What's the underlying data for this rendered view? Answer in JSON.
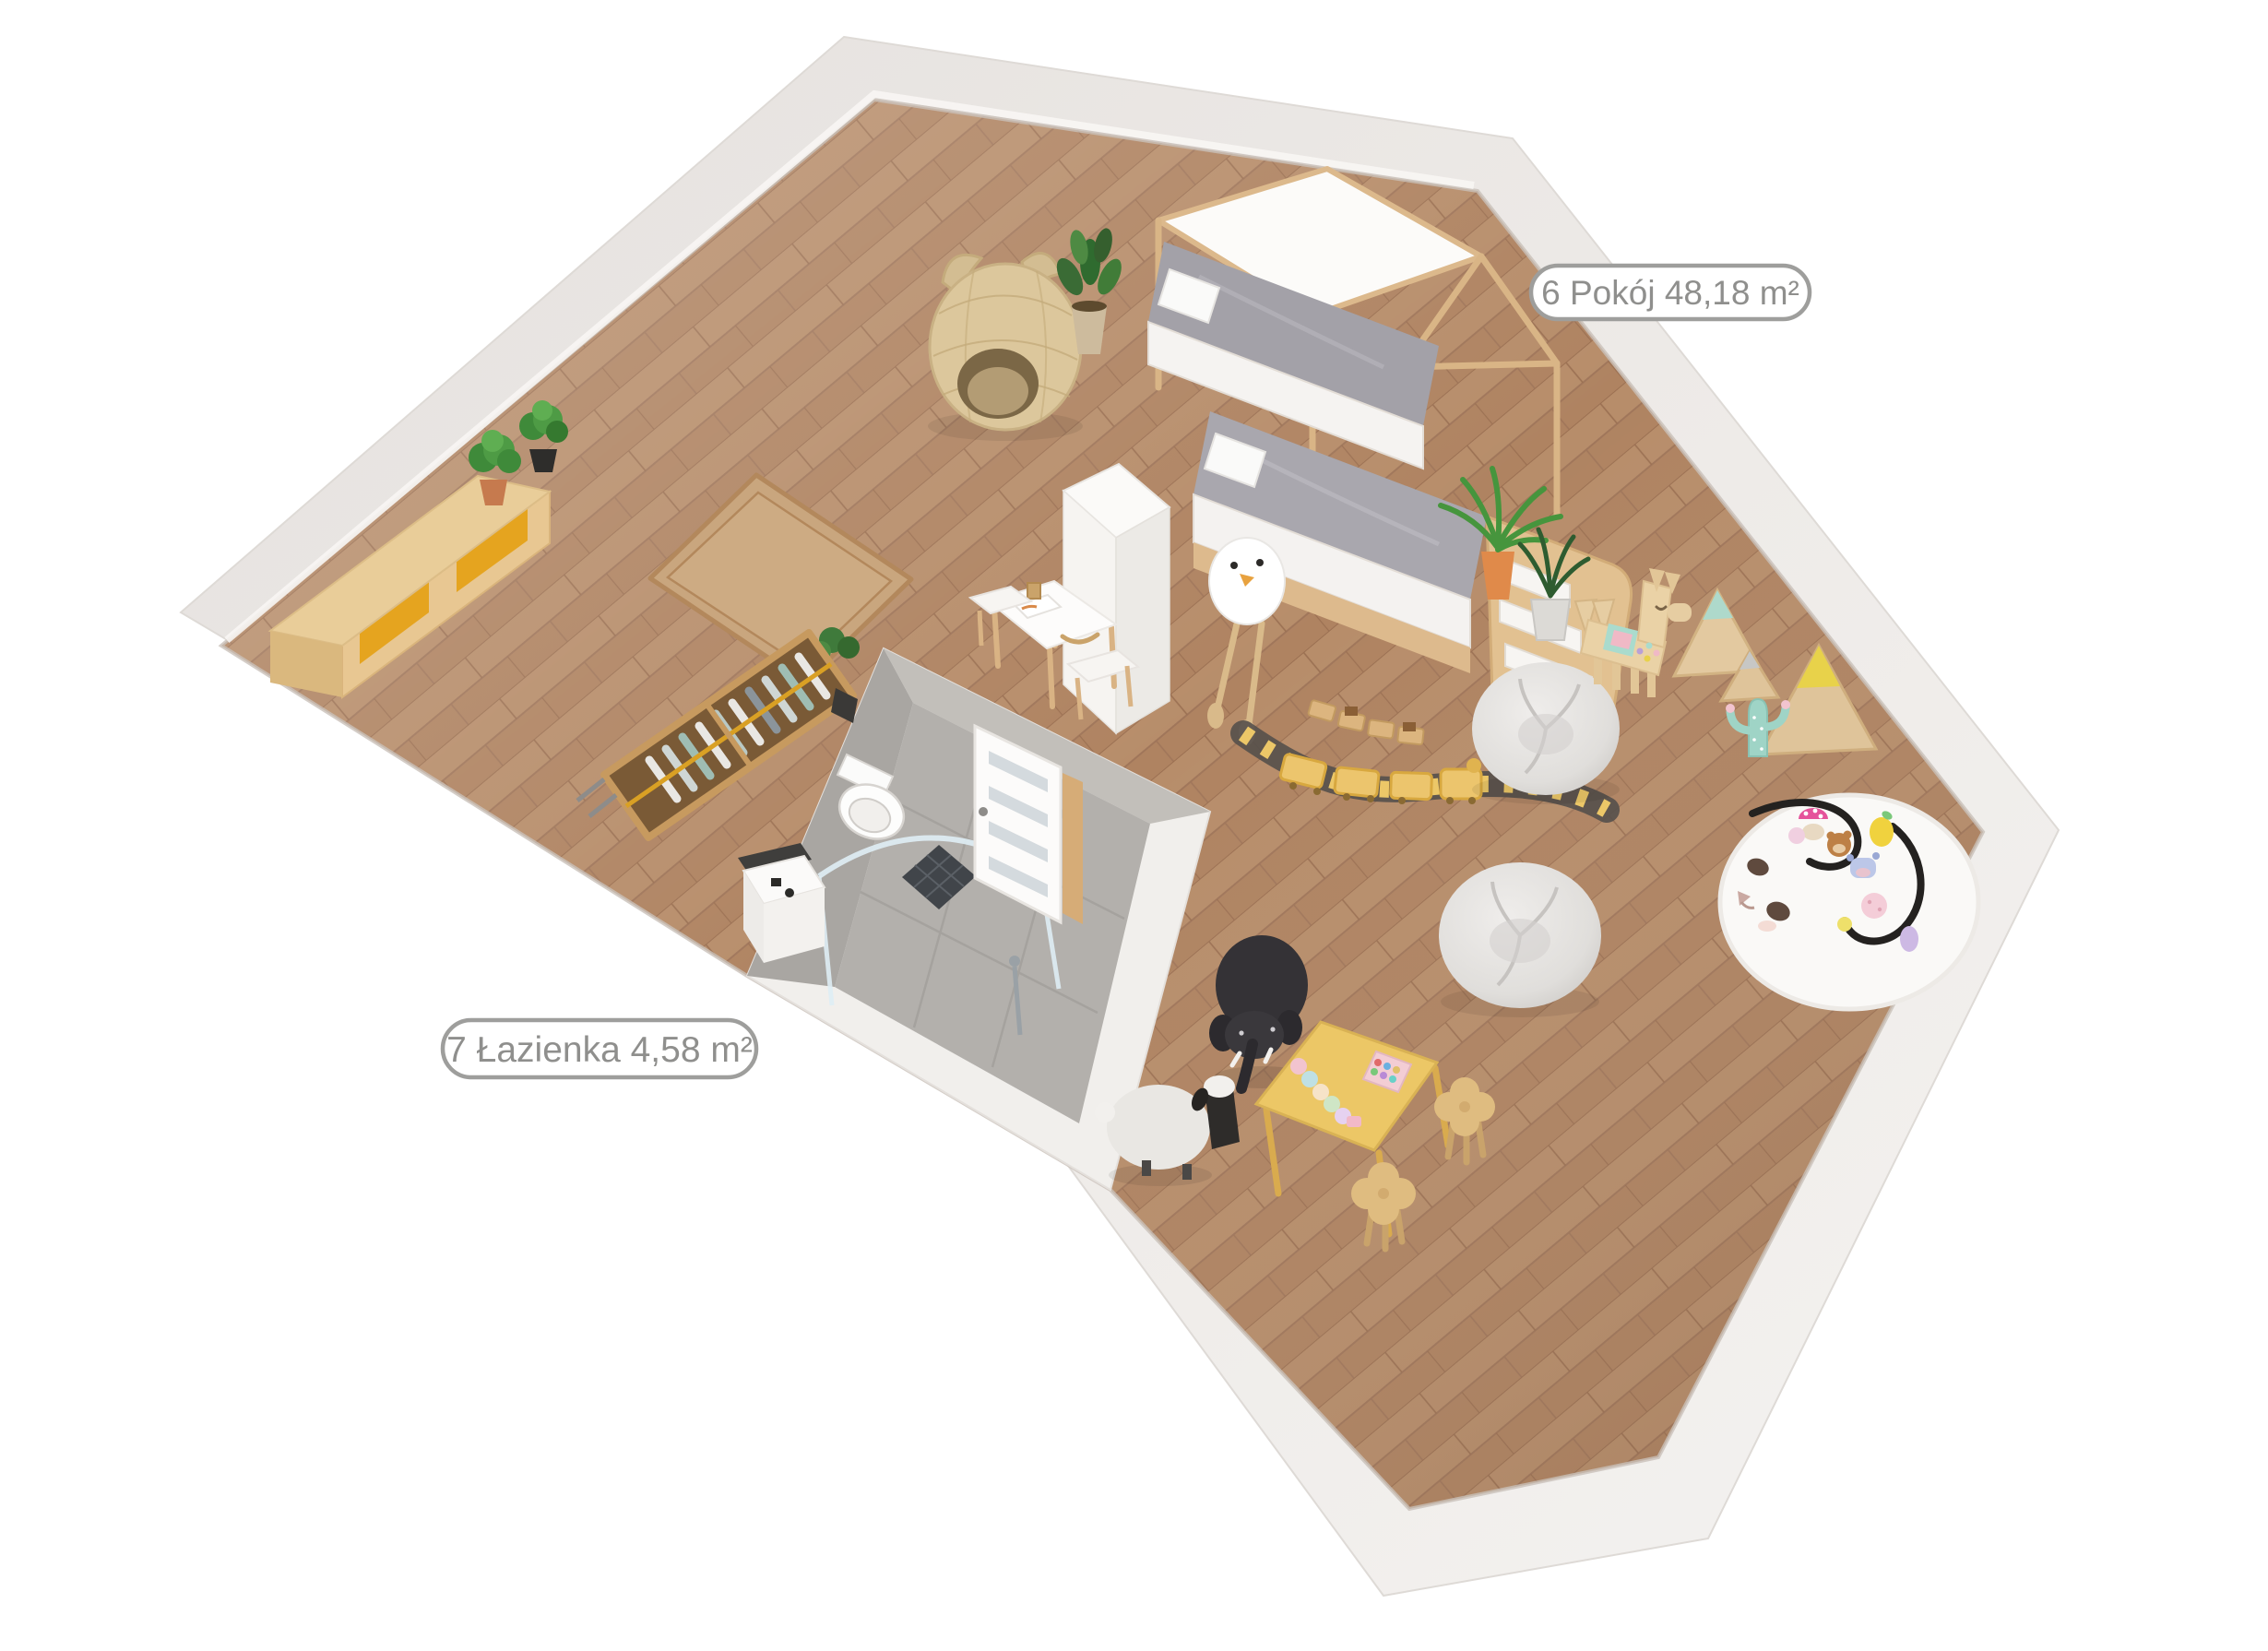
{
  "view": {
    "type": "3d-floorplan-render",
    "floor_name": "children's room with bathroom"
  },
  "labels": {
    "room": {
      "number": "6",
      "name": "Pokój",
      "area": "48,18 m²",
      "full": "6 Pokój 48,18 m²"
    },
    "bathroom": {
      "number": "7",
      "name": "Łazienka",
      "area": "4,58 m²",
      "full": "7 Łazienka 4,58 m²"
    }
  },
  "palette": {
    "background": "#ffffff",
    "wall_top": "#e9e5e2",
    "wall_light": "#f3f1ef",
    "floor_wood": "#b78d6a",
    "floor_wood_dark": "#a67c5d",
    "bathroom_floor": "#b3b0ac",
    "bathroom_wall": "#a9a6a2",
    "accent_drawer_yellow": "#e5a41f",
    "kids_table_yellow": "#ecc766",
    "mint": "#a8d8cc",
    "cap_yellow": "#e8d24a",
    "plant_green": "#46953d",
    "train_track": "#55504b",
    "label_border": "#9e9e9c",
    "label_text": "#8f8f8d",
    "mattress_gray": "#a3a1a8",
    "wood_frame": "#dcb98c"
  },
  "scene": {
    "objects": [
      "outer-walls",
      "wood-floor",
      "floor-hatch",
      "sideboard",
      "potted-plants",
      "cat-ear-basket",
      "house-frame-bunk-bed",
      "bird-plush",
      "stairs-drawers",
      "tall-white-cabinet",
      "kids-desk",
      "open-wardrobe",
      "bathroom",
      "toilet",
      "shower",
      "shower-drain",
      "bathroom-door",
      "bathroom-cabinet",
      "toy-train-track",
      "yellow-toy-train",
      "wooden-toy-train",
      "bean-bag-1",
      "bean-bag-2",
      "wooden-llama",
      "mountain-triangles",
      "cactus-decor",
      "bunny-rug",
      "plush-toys",
      "elephant-pouf",
      "sheep-pouf",
      "kids-table",
      "clover-stool-1",
      "clover-stool-2"
    ]
  }
}
